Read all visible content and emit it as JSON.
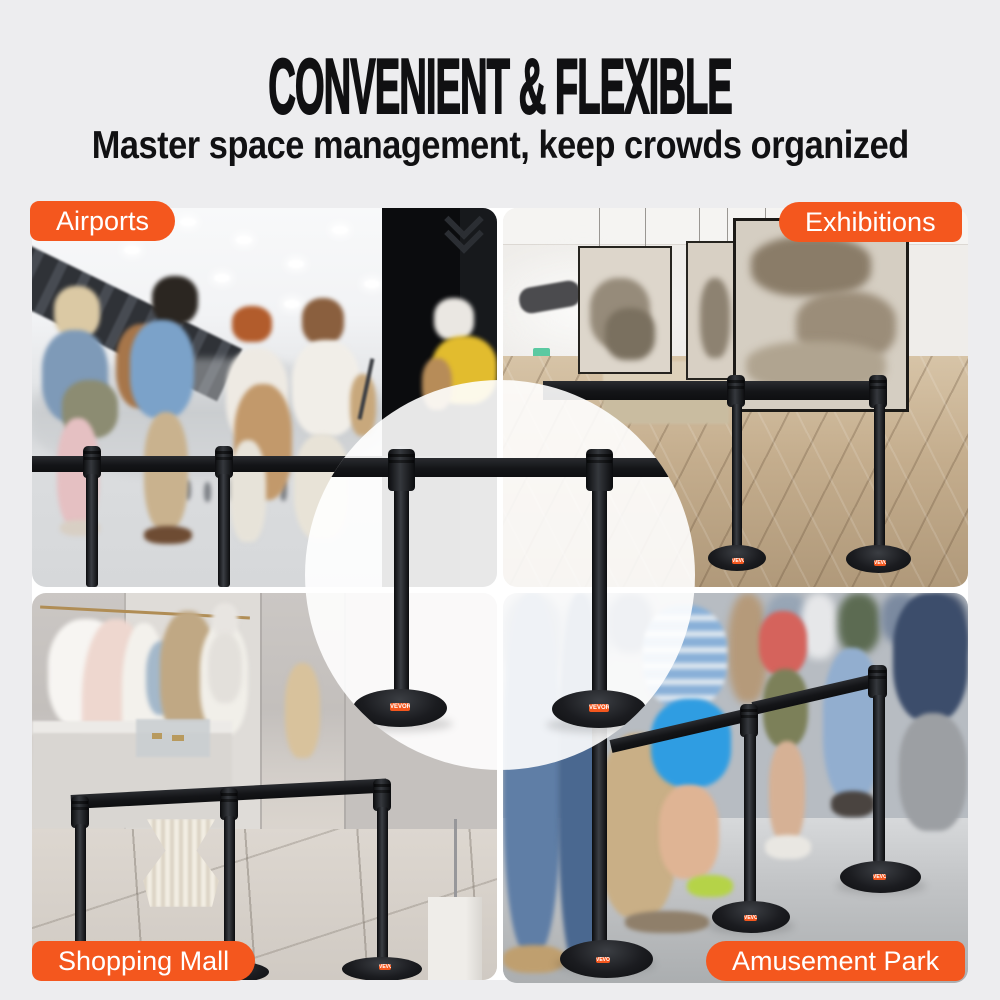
{
  "header": {
    "title": "CONVENIENT & FLEXIBLE",
    "subtitle": "Master space management, keep crowds organized"
  },
  "scenes": {
    "airports": {
      "label": "Airports"
    },
    "exhibitions": {
      "label": "Exhibitions"
    },
    "shopping_mall": {
      "label": "Shopping Mall"
    },
    "amusement_park": {
      "label": "Amusement Park"
    }
  },
  "product": {
    "brand_chip": "VEVOR"
  },
  "colors": {
    "accent_orange": "#F4571E",
    "page_background": "#EDEDEF",
    "belt_black": "#17181B",
    "label_text": "#FFFFFF",
    "title_text": "#101012"
  }
}
